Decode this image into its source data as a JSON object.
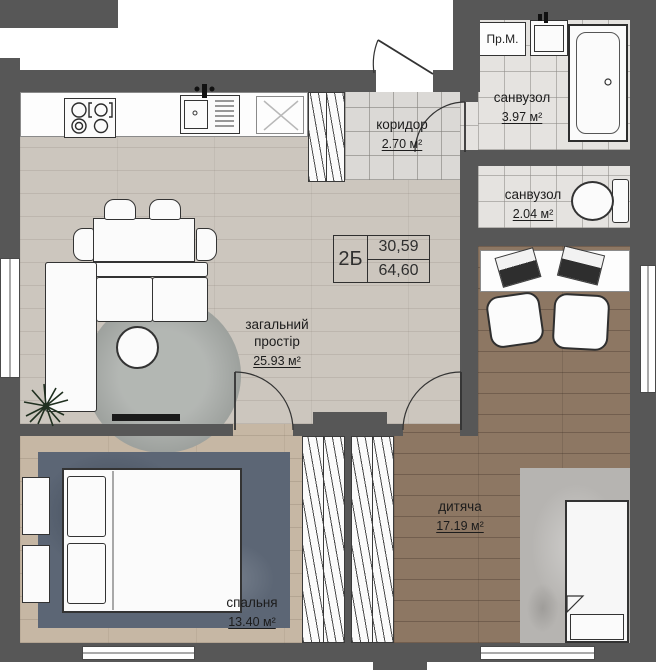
{
  "plan": {
    "unit_label": "2Б",
    "area_living_total": "30,59",
    "area_total": "64,60",
    "rooms": {
      "living": {
        "name": "загальний простір",
        "area": "25.93 м²"
      },
      "corridor": {
        "name": "коридор",
        "area": "2.70 м²"
      },
      "bathroom_top": {
        "name": "санвузол",
        "area": "3.97 м²"
      },
      "bathroom_small": {
        "name": "санвузол",
        "area": "2.04 м²"
      },
      "bedroom": {
        "name": "спальня",
        "area": "13.40 м²"
      },
      "kids_room": {
        "name": "дитяча",
        "area": "17.19 м²"
      }
    },
    "labels": {
      "washing_machine": "Пр.М."
    },
    "colors": {
      "wall": "#575757",
      "floor_living": "#ccc6be",
      "floor_bedroom": "#c6b7a4",
      "floor_kids": "#8d7763",
      "tile": "#e5e3e0",
      "rug_blue": "#5c6675",
      "rug_gray": "#b6b4b1",
      "rug_round": "#a5a9a5"
    }
  }
}
